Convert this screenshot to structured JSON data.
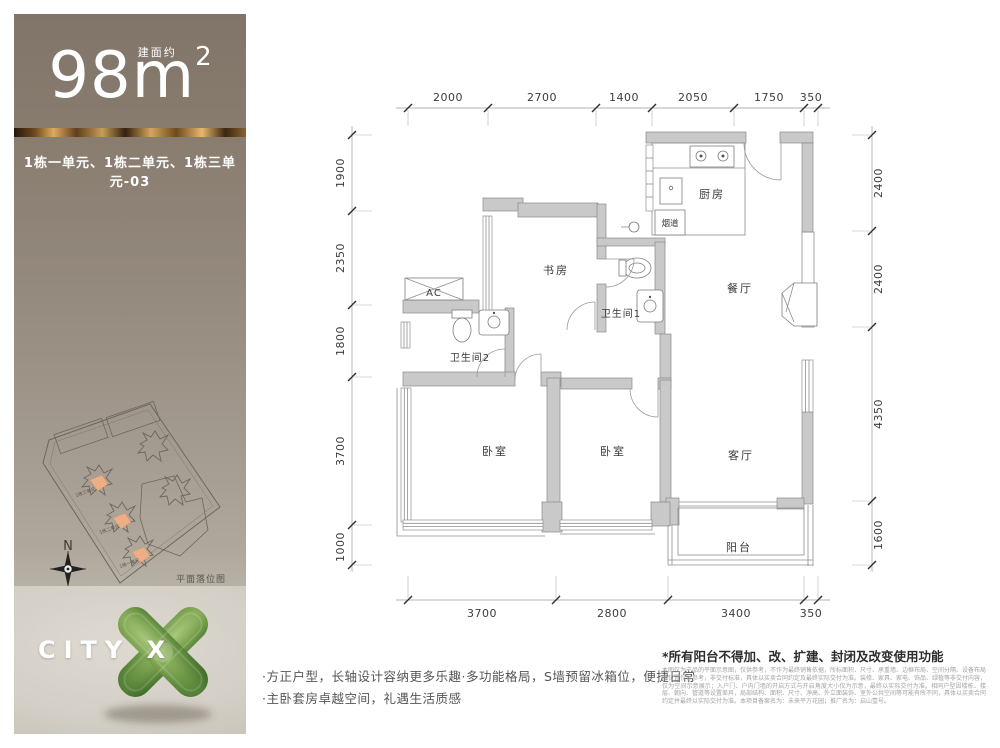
{
  "sidebar": {
    "area": {
      "number": "98",
      "unit": "m",
      "sup": "2",
      "note": "建面约"
    },
    "units_line": "1栋一单元、1栋二单元、1栋三单元-03",
    "siteplan": {
      "building_labels": [
        "1栋三单元",
        "1栋二单元",
        "1栋一单元"
      ],
      "caption": "平面落位图",
      "compass": "N"
    },
    "brand": "CITY X"
  },
  "plan": {
    "dims_top": [
      "2000",
      "2700",
      "1400",
      "2050",
      "1750",
      "350"
    ],
    "dims_left": [
      "1900",
      "2350",
      "1800",
      "3700",
      "1000"
    ],
    "dims_right": [
      "2400",
      "2400",
      "4350",
      "1600"
    ],
    "dims_bottom": [
      "3700",
      "2800",
      "3400",
      "350"
    ],
    "rooms": {
      "kitchen": "厨房",
      "flue": "烟道",
      "study": "书房",
      "bath1": "卫生间1",
      "bath2": "卫生间2",
      "ac": "AC",
      "dining": "餐厅",
      "bedroom_left": "卧室",
      "bedroom_right": "卧室",
      "living": "客厅",
      "balcony": "阳台"
    }
  },
  "notes": {
    "balcony_warning": "*所有阳台不得加、改、扩建、封闭及改变使用功能",
    "legal": "本图仅为产品的平面示意图，仅供参考，不作为最终销售依据，所标面积、尺寸、承重墙、边框布局、空间分隔、设备布局等位置仅供参考，非交付标准，具体以买卖合同约定及最终实际交付为准。装修、家具、家电、饰品、绿植等非交付内容，仅为空间示意展示；入户门、户内门墙的开启方式与开启角度大小仅为示意，最终以实际交付为准。相同户型因楼栋、楼层、朝向、管道等设置差异，局部结构、面积、尺寸、净高、外立面装饰、室外公共空间等可能有所不同，具体以买卖合同约定并最终以实际交付为准。本项目备案名为：未来平方花园；推广名为：启山壹号。",
    "bullet1": "·方正户型，长轴设计容纳更多乐趣·多功能格局，S墙预留冰箱位，便捷日常",
    "bullet2": "·主卧套房卓越空间，礼遇生活质感"
  }
}
